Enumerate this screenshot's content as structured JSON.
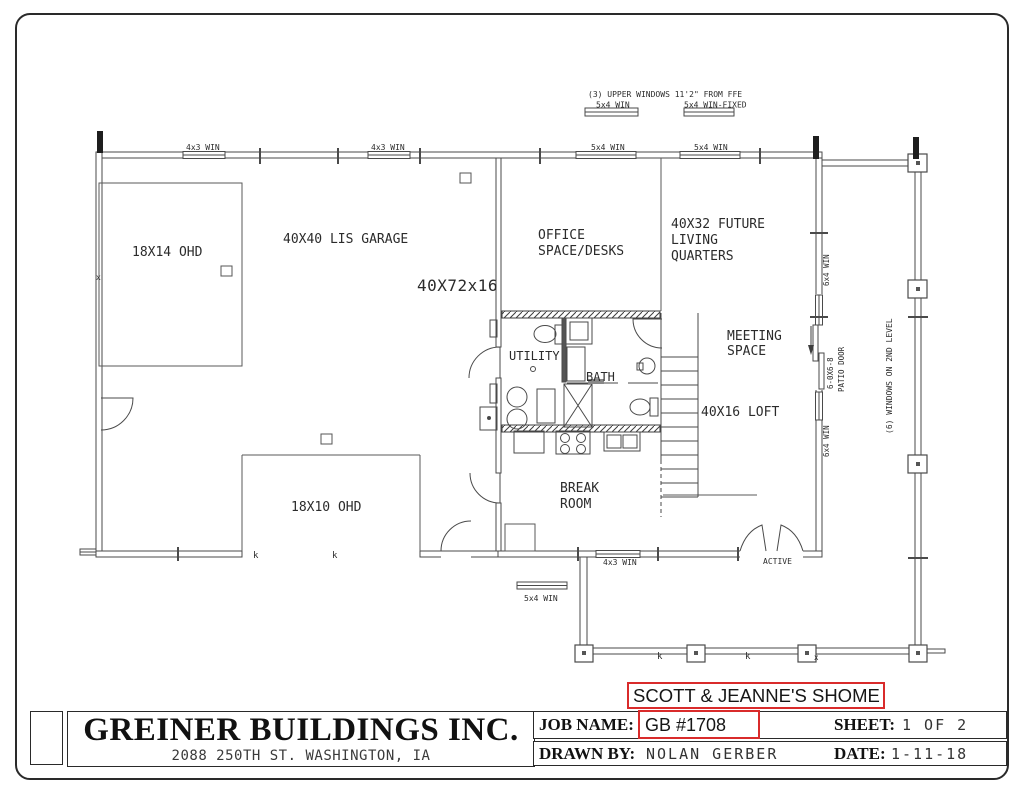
{
  "colors": {
    "line": "#4a4a4a",
    "annotation_red": "#d92b2b",
    "text": "#2b2b2b"
  },
  "plan": {
    "notes": {
      "upper_windows": "(3) UPPER WINDOWS 11'2\" FROM FFE",
      "upper_win_left": "5x4 WIN",
      "upper_win_right": "5x4 WIN-FIXED"
    },
    "windows": {
      "top1": "4x3 WIN",
      "top2": "4x3 WIN",
      "top3": "5x4 WIN",
      "top4": "5x4 WIN",
      "bottom": "4x3 WIN",
      "porch": "5x4 WIN"
    },
    "right_wall": {
      "win_upper": "6x4 WIN",
      "win_lower": "6x4 WIN",
      "second_level": "(6) WINDOWS ON 2ND LEVEL"
    },
    "doors": {
      "active": "ACTIVE",
      "patio": [
        "6-0X6-8",
        "PATIO DOOR"
      ]
    },
    "rooms": {
      "ohd_left": "18X14 OHD",
      "garage": "40X40 LIS GARAGE",
      "building_dims": "40X72x16",
      "office": [
        "OFFICE",
        "SPACE/DESKS"
      ],
      "future_living": [
        "40X32 FUTURE",
        "LIVING",
        "QUARTERS"
      ],
      "meeting": [
        "MEETING",
        "SPACE"
      ],
      "utility": "UTILITY",
      "bath": "BATH",
      "loft": "40X16 LOFT",
      "break_room": [
        "BREAK",
        "ROOM"
      ],
      "ohd_bottom": "18X10 OHD"
    },
    "marks": {
      "k": "k",
      "x": "x"
    }
  },
  "title_block": {
    "company": "GREINER BUILDINGS INC.",
    "address": "2088 250TH ST. WASHINGTON, IA",
    "project": "SCOTT & JEANNE'S SHOME",
    "job_label": "JOB NAME:",
    "job_value": "GB #1708",
    "sheet_label": "SHEET:",
    "sheet_value": "1 OF 2",
    "drawn_label": "DRAWN BY:",
    "drawn_value": "NOLAN GERBER",
    "date_label": "DATE:",
    "date_value": "1-11-18"
  }
}
